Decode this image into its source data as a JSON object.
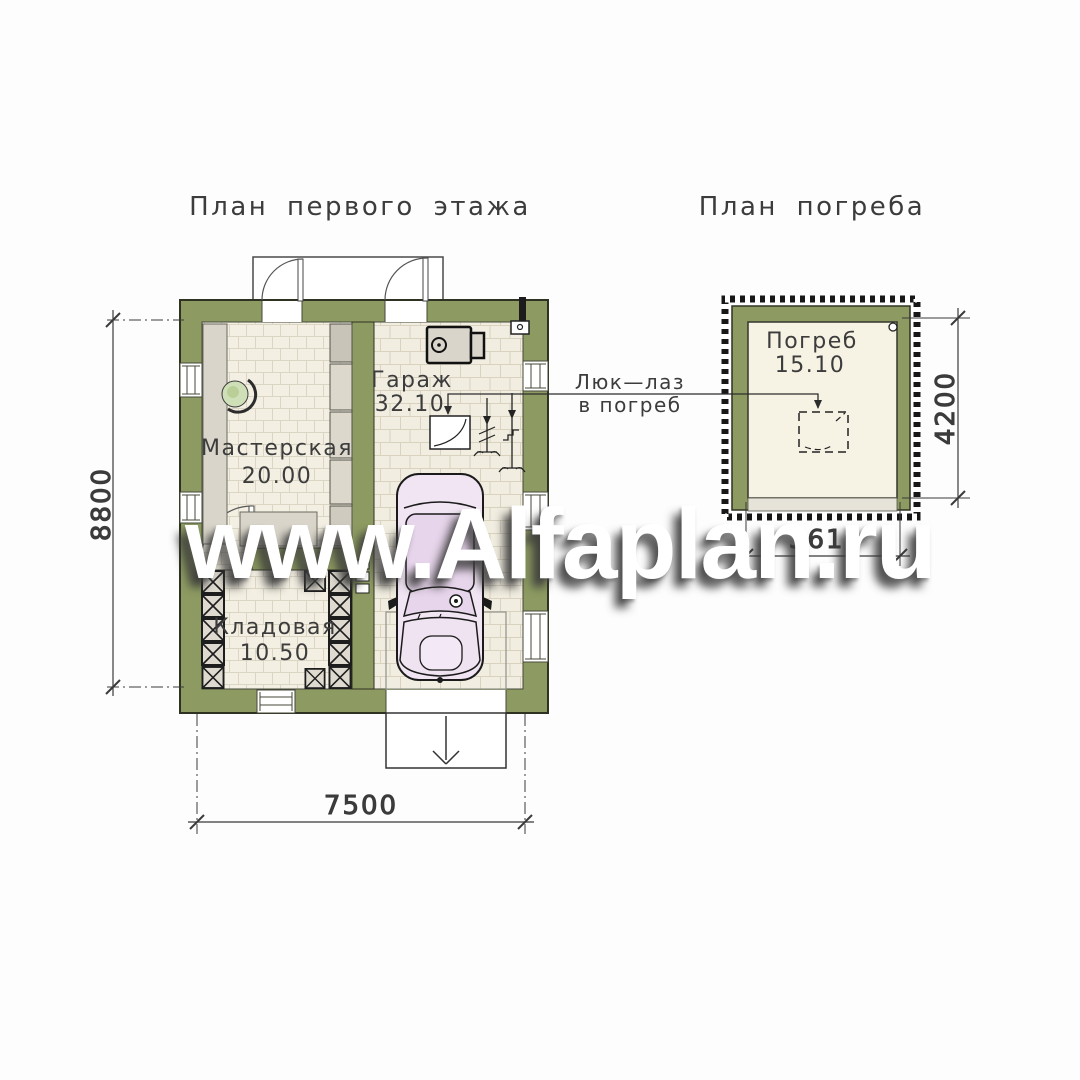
{
  "titles": {
    "first_floor": "План первого этажа",
    "cellar": "План погреба"
  },
  "rooms": {
    "workshop": {
      "name": "Мастерская",
      "area": "20.00"
    },
    "garage": {
      "name": "Гараж",
      "area": "32.10"
    },
    "storage": {
      "name": "Кладовая",
      "area": "10.50"
    },
    "cellar": {
      "name": "Погреб",
      "area": "15.10"
    }
  },
  "callout": {
    "line1": "Люк—лаз",
    "line2": "в погреб"
  },
  "dimensions": {
    "plan_height": "8800",
    "plan_width": "7500",
    "cellar_height": "4200",
    "cellar_width": "3610"
  },
  "watermark": "www.Alfaplan.ru",
  "colors": {
    "wall_olive": "#8d9b62",
    "floor_beige": "#f3efe2",
    "line_dark": "#3a3a3a",
    "car_body": "#f1e5f3"
  }
}
